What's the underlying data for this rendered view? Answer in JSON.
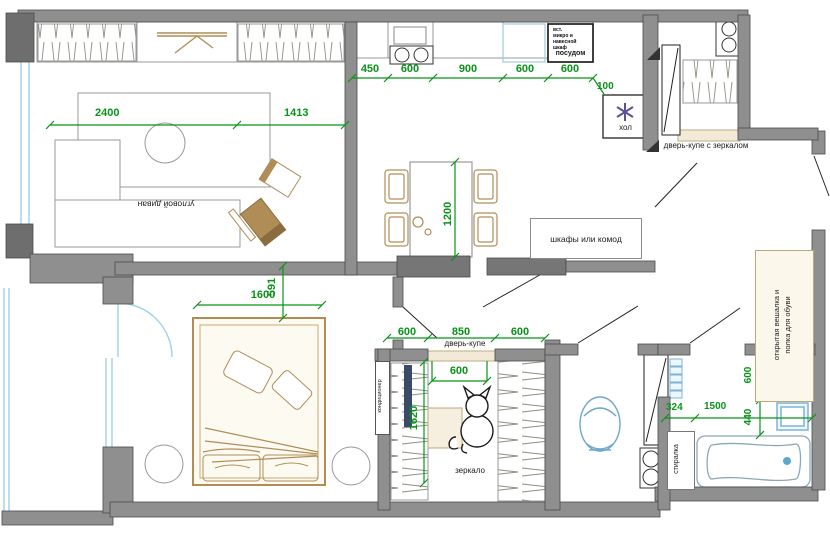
{
  "plan": {
    "living_room": {
      "sofa_label": "угловой диван",
      "dim_left": "2400",
      "dim_right": "1413"
    },
    "kitchen": {
      "dims": [
        "450",
        "600",
        "900",
        "600",
        "600"
      ],
      "dim_fridge_offset": "100",
      "fridge_label": "хол",
      "cabinet_note": [
        "вст.",
        "микро и",
        "навесной",
        "шкаф"
      ],
      "cabinet_label": "посудом"
    },
    "dining": {
      "dim_table": "1200"
    },
    "hall": {
      "closet_label": "дверь-купе с зеркалом",
      "dresser_label": "шкафы или комод",
      "hanger_label": [
        "открытая вешалка и",
        "полка для обуви"
      ]
    },
    "bedroom": {
      "dim_bed": "1600",
      "dim_offset": "591",
      "ac_label": "кондиционер"
    },
    "wardrobe": {
      "dims": [
        "600",
        "850",
        "600"
      ],
      "door_label": "дверь-купе",
      "dim_door": "600",
      "dim_depth": "1620",
      "mirror_label": "зеркало"
    },
    "bathroom": {
      "washer_label": "стиралка",
      "dim_shelf": "324",
      "dim_tub": "1500",
      "dim_washer": "600",
      "dim_sink": "440"
    }
  }
}
